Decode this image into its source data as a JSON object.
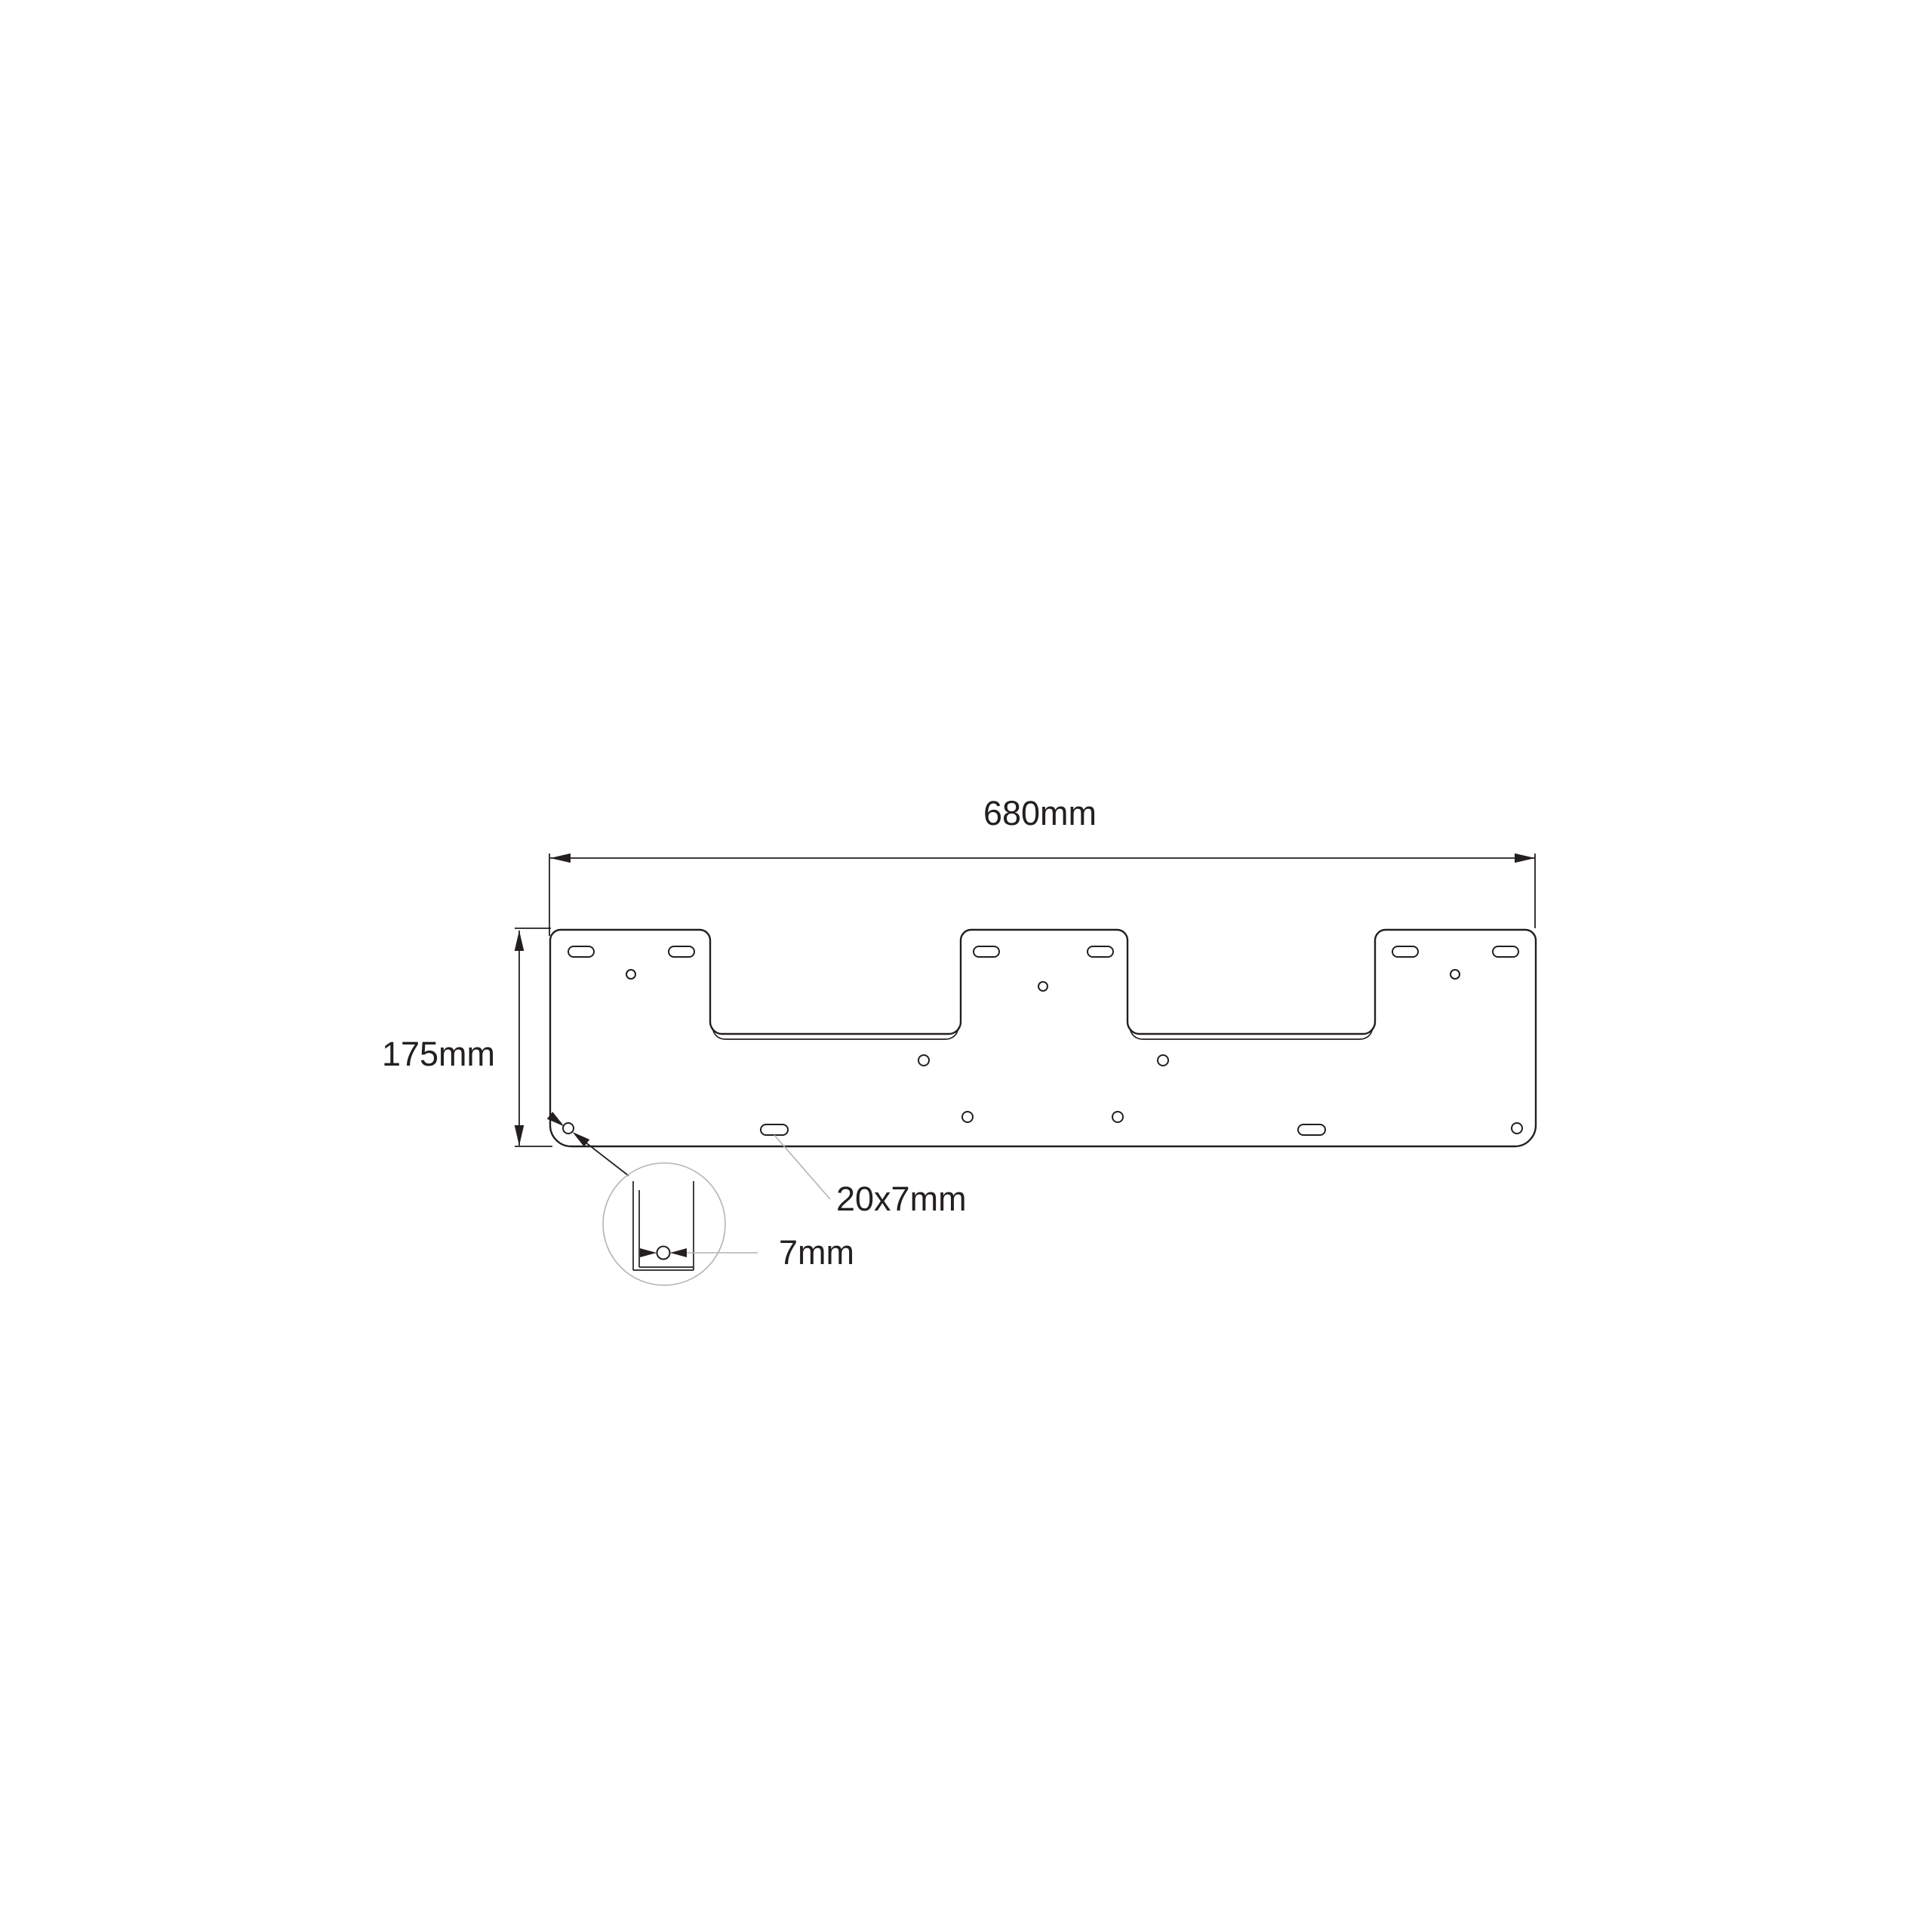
{
  "drawing": {
    "labels": {
      "width": "680mm",
      "height": "175mm",
      "slot_size": "20x7mm",
      "hole_diameter": "7mm"
    },
    "dimensions_mm": {
      "plate_width": 680,
      "plate_height": 175,
      "slot": "20x7",
      "hole_diameter": 7
    },
    "colors": {
      "line": "#231f20",
      "leader": "#b3b3b3",
      "text": "#231f20",
      "background": "#ffffff"
    }
  }
}
